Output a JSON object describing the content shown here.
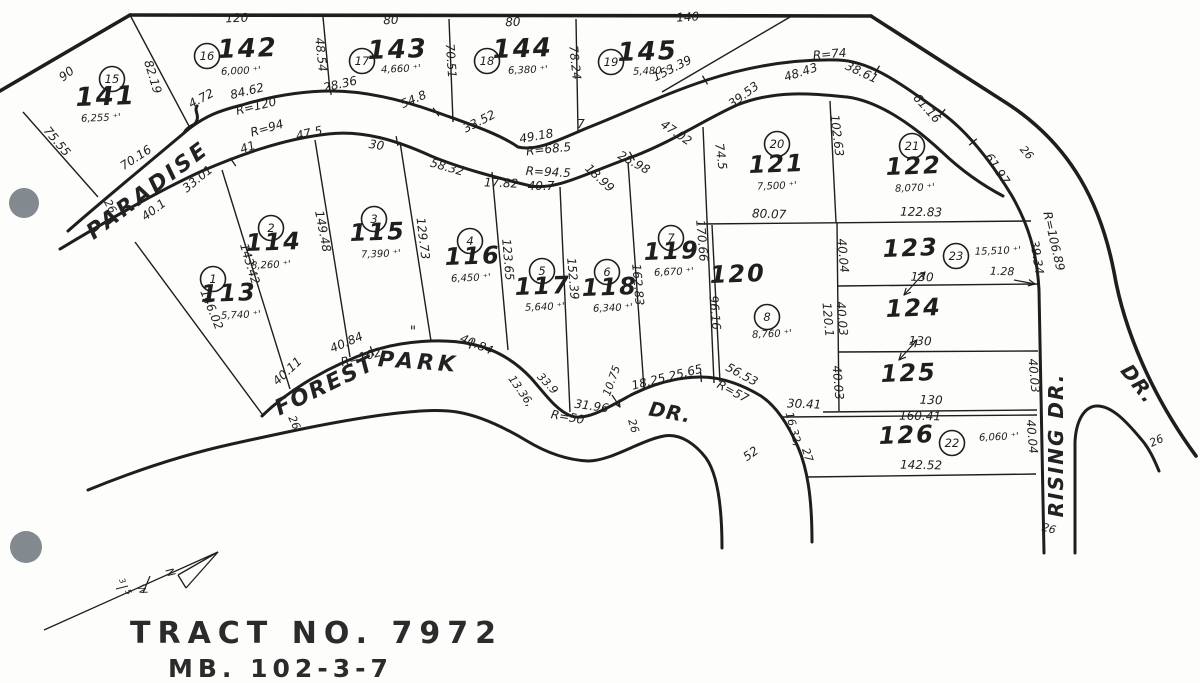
{
  "title": "TRACT  NO.  7972",
  "subtitle": "MB. 102-3-7",
  "area_suffix": " ⁺'",
  "scan": {
    "paper": "#fdfdfc",
    "ink": "#1e1e1e",
    "punch_color": "#828a90",
    "hole_punches": [
      [
        24,
        203,
        15
      ],
      [
        26,
        547,
        16
      ]
    ]
  },
  "streets": [
    {
      "name": "PARADISE",
      "x": 152,
      "y": 196,
      "r": -37,
      "s": 22,
      "ls": 3
    },
    {
      "name": "FOREST",
      "x": 328,
      "y": 392,
      "r": -26,
      "s": 22,
      "ls": 2
    },
    {
      "name": "PARK",
      "x": 418,
      "y": 369,
      "r": 4,
      "s": 22,
      "ls": 4
    },
    {
      "name": "DR.",
      "x": 669,
      "y": 419,
      "r": 10,
      "s": 20,
      "ls": 1
    },
    {
      "name": "RISING  DR.",
      "x": 1063,
      "y": 445,
      "r": -90,
      "s": 20,
      "ls": 2
    },
    {
      "name": "DR.",
      "x": 1133,
      "y": 388,
      "r": 52,
      "s": 20,
      "ls": 1
    }
  ],
  "lots": [
    {
      "number": "141",
      "badge": "15",
      "area": "6,255",
      "num": [
        106,
        105,
        26
      ],
      "badge_pos": [
        112,
        79
      ],
      "area_pos": [
        101,
        121
      ]
    },
    {
      "number": "142",
      "badge": "16",
      "area": "6,000",
      "num": [
        248,
        57,
        26
      ],
      "badge_pos": [
        207,
        56
      ],
      "area_pos": [
        241,
        74
      ]
    },
    {
      "number": "143",
      "badge": "17",
      "area": "4,660",
      "num": [
        398,
        58,
        26
      ],
      "badge_pos": [
        362,
        61
      ],
      "area_pos": [
        401,
        72
      ]
    },
    {
      "number": "144",
      "badge": "18",
      "area": "6,380",
      "num": [
        523,
        57,
        26
      ],
      "badge_pos": [
        487,
        61
      ],
      "area_pos": [
        528,
        73
      ]
    },
    {
      "number": "145",
      "badge": "19",
      "area": "5,480",
      "num": [
        648,
        60,
        26
      ],
      "badge_pos": [
        611,
        62
      ],
      "area_pos": [
        653,
        74
      ]
    },
    {
      "number": "113",
      "badge": "1",
      "area": "5,740",
      "num": [
        229,
        301,
        24
      ],
      "badge_pos": [
        213,
        279
      ],
      "area_pos": [
        241,
        318
      ]
    },
    {
      "number": "114",
      "badge": "2",
      "area": "8,260",
      "num": [
        274,
        250,
        24
      ],
      "badge_pos": [
        271,
        228
      ],
      "area_pos": [
        271,
        268
      ]
    },
    {
      "number": "115",
      "badge": "3",
      "area": "7,390",
      "num": [
        378,
        240,
        24
      ],
      "badge_pos": [
        374,
        219
      ],
      "area_pos": [
        381,
        257
      ]
    },
    {
      "number": "116",
      "badge": "4",
      "area": "6,450",
      "num": [
        473,
        264,
        24
      ],
      "badge_pos": [
        470,
        241
      ],
      "area_pos": [
        471,
        281
      ]
    },
    {
      "number": "117",
      "badge": "5",
      "area": "5,640",
      "num": [
        543,
        294,
        24
      ],
      "badge_pos": [
        542,
        271
      ],
      "area_pos": [
        545,
        310
      ]
    },
    {
      "number": "118",
      "badge": "6",
      "area": "6,340",
      "num": [
        610,
        295,
        24
      ],
      "badge_pos": [
        607,
        272
      ],
      "area_pos": [
        613,
        311
      ]
    },
    {
      "number": "119",
      "badge": "7",
      "area": "6,670",
      "num": [
        672,
        259,
        24
      ],
      "badge_pos": [
        671,
        238
      ],
      "area_pos": [
        674,
        275
      ]
    },
    {
      "number": "120",
      "badge": "8",
      "area": "8,760",
      "num": [
        738,
        282,
        24
      ],
      "badge_pos": [
        767,
        317
      ],
      "area_pos": [
        772,
        337
      ]
    },
    {
      "number": "121",
      "badge": "20",
      "area": "7,500",
      "num": [
        777,
        172,
        24
      ],
      "badge_pos": [
        777,
        144
      ],
      "area_pos": [
        777,
        189
      ]
    },
    {
      "number": "122",
      "badge": "21",
      "area": "8,070",
      "num": [
        914,
        174,
        24
      ],
      "badge_pos": [
        912,
        146
      ],
      "area_pos": [
        915,
        191
      ]
    },
    {
      "number": "123",
      "badge": "23",
      "area": "15,510",
      "num": [
        911,
        256,
        24
      ],
      "badge_pos": [
        956,
        256
      ],
      "area_pos": [
        998,
        254
      ]
    },
    {
      "number": "124",
      "num": [
        914,
        316,
        24
      ]
    },
    {
      "number": "125",
      "num": [
        909,
        381,
        24
      ]
    },
    {
      "number": "126",
      "badge": "22",
      "area": "6,060",
      "num": [
        907,
        443,
        24
      ],
      "badge_pos": [
        952,
        443
      ],
      "area_pos": [
        999,
        440
      ]
    }
  ],
  "dims": [
    {
      "t": "120",
      "x": 237,
      "y": 22,
      "r": -2
    },
    {
      "t": "80",
      "x": 391,
      "y": 24,
      "r": -2
    },
    {
      "t": "80",
      "x": 513,
      "y": 26,
      "r": -2
    },
    {
      "t": "140",
      "x": 688,
      "y": 21,
      "r": -3
    },
    {
      "t": "90",
      "x": 69,
      "y": 77,
      "r": -38
    },
    {
      "t": "82.19",
      "x": 149,
      "y": 78,
      "r": 73
    },
    {
      "t": "48.54",
      "x": 317,
      "y": 55,
      "r": 84
    },
    {
      "t": "70.51",
      "x": 447,
      "y": 61,
      "r": 86
    },
    {
      "t": "78.24",
      "x": 571,
      "y": 63,
      "r": 84
    },
    {
      "t": "153.39",
      "x": 674,
      "y": 72,
      "r": -27
    },
    {
      "t": "75.55",
      "x": 54,
      "y": 144,
      "r": 50
    },
    {
      "t": "70.16",
      "x": 138,
      "y": 161,
      "r": -33
    },
    {
      "t": "4.72",
      "x": 203,
      "y": 102,
      "r": -28
    },
    {
      "t": "84.62",
      "x": 248,
      "y": 95,
      "r": -14
    },
    {
      "t": "R=120",
      "x": 257,
      "y": 110,
      "r": -14
    },
    {
      "t": "28.36",
      "x": 341,
      "y": 88,
      "r": -13
    },
    {
      "t": "54.8",
      "x": 415,
      "y": 103,
      "r": -23
    },
    {
      "t": "33.52",
      "x": 481,
      "y": 125,
      "r": -27
    },
    {
      "t": "49.18",
      "x": 537,
      "y": 140,
      "r": -10
    },
    {
      "t": "R=68.5",
      "x": 549,
      "y": 153,
      "r": -6
    },
    {
      "t": "7",
      "x": 581,
      "y": 128,
      "r": 0
    },
    {
      "t": "39.53",
      "x": 746,
      "y": 98,
      "r": -37
    },
    {
      "t": "48.43",
      "x": 802,
      "y": 76,
      "r": -18
    },
    {
      "t": "R=74",
      "x": 830,
      "y": 58,
      "r": -5
    },
    {
      "t": "38.61",
      "x": 860,
      "y": 76,
      "r": 25
    },
    {
      "t": "61.16",
      "x": 924,
      "y": 111,
      "r": 48
    },
    {
      "t": "61.97",
      "x": 994,
      "y": 171,
      "r": 57
    },
    {
      "t": "26",
      "x": 1024,
      "y": 155,
      "r": 48,
      "s": 11
    },
    {
      "t": "39.34",
      "x": 1033,
      "y": 258,
      "r": 81
    },
    {
      "t": "R=106.89",
      "x": 1050,
      "y": 242,
      "r": 77
    },
    {
      "t": "R=94",
      "x": 268,
      "y": 132,
      "r": -16
    },
    {
      "t": "41",
      "x": 249,
      "y": 151,
      "r": -19
    },
    {
      "t": "47.5",
      "x": 310,
      "y": 137,
      "r": -13
    },
    {
      "t": "30",
      "x": 376,
      "y": 149,
      "r": 8
    },
    {
      "t": "58.32",
      "x": 446,
      "y": 171,
      "r": 16
    },
    {
      "t": "R=94.5",
      "x": 548,
      "y": 176,
      "r": 3
    },
    {
      "t": "17.82",
      "x": 501,
      "y": 187,
      "r": 2
    },
    {
      "t": "40.7",
      "x": 541,
      "y": 190,
      "r": 0
    },
    {
      "t": "18.99",
      "x": 597,
      "y": 181,
      "r": 43
    },
    {
      "t": "26.98",
      "x": 632,
      "y": 166,
      "r": 29
    },
    {
      "t": "47.02",
      "x": 674,
      "y": 136,
      "r": 34
    },
    {
      "t": "40.1",
      "x": 156,
      "y": 213,
      "r": -37
    },
    {
      "t": "33.01",
      "x": 200,
      "y": 182,
      "r": -39
    },
    {
      "t": "74.5",
      "x": 717,
      "y": 157,
      "r": 82
    },
    {
      "t": "102.63",
      "x": 833,
      "y": 136,
      "r": 83
    },
    {
      "t": "170.66",
      "x": 698,
      "y": 241,
      "r": 85
    },
    {
      "t": "96.16",
      "x": 711,
      "y": 313,
      "r": 85
    },
    {
      "t": "143.42",
      "x": 246,
      "y": 265,
      "r": 73
    },
    {
      "t": "146.02",
      "x": 208,
      "y": 311,
      "r": 68
    },
    {
      "t": "149.48",
      "x": 319,
      "y": 232,
      "r": 79
    },
    {
      "t": "129.73",
      "x": 419,
      "y": 239,
      "r": 83
    },
    {
      "t": "123.65",
      "x": 504,
      "y": 260,
      "r": 85
    },
    {
      "t": "152.39",
      "x": 569,
      "y": 279,
      "r": 85
    },
    {
      "t": "162.83",
      "x": 634,
      "y": 285,
      "r": 85
    },
    {
      "t": "80.07",
      "x": 769,
      "y": 218,
      "r": 2
    },
    {
      "t": "122.83",
      "x": 921,
      "y": 216,
      "r": 1
    },
    {
      "t": "40.04",
      "x": 839,
      "y": 256,
      "r": 85
    },
    {
      "t": "40.03",
      "x": 838,
      "y": 319,
      "r": 85
    },
    {
      "t": "120.1",
      "x": 824,
      "y": 320,
      "r": 85
    },
    {
      "t": "130",
      "x": 922,
      "y": 281,
      "r": 2
    },
    {
      "t": "1.28",
      "x": 1002,
      "y": 275,
      "r": 2,
      "s": 11
    },
    {
      "t": "130",
      "x": 920,
      "y": 345,
      "r": 2
    },
    {
      "t": "40.03",
      "x": 834,
      "y": 383,
      "r": 85
    },
    {
      "t": "40.03",
      "x": 1030,
      "y": 376,
      "r": 85
    },
    {
      "t": "130",
      "x": 931,
      "y": 404,
      "r": 2
    },
    {
      "t": "160.41",
      "x": 920,
      "y": 420,
      "r": 1
    },
    {
      "t": "30.41",
      "x": 804,
      "y": 408,
      "r": 2
    },
    {
      "t": "16.32,",
      "x": 790,
      "y": 430,
      "r": 75,
      "s": 11
    },
    {
      "t": "27",
      "x": 804,
      "y": 456,
      "r": 72,
      "s": 11
    },
    {
      "t": "40.04",
      "x": 1028,
      "y": 437,
      "r": 85
    },
    {
      "t": "142.52",
      "x": 921,
      "y": 469,
      "r": 1
    },
    {
      "t": "26",
      "x": 1048,
      "y": 532,
      "r": 15,
      "s": 11
    },
    {
      "t": "26",
      "x": 1158,
      "y": 444,
      "r": -25,
      "s": 11
    },
    {
      "t": "40.11",
      "x": 290,
      "y": 374,
      "r": -43
    },
    {
      "t": "40.84",
      "x": 348,
      "y": 346,
      "r": -23
    },
    {
      "t": "R=102",
      "x": 362,
      "y": 361,
      "r": -15
    },
    {
      "t": "\"",
      "x": 413,
      "y": 336,
      "r": 0,
      "s": 14
    },
    {
      "t": "40.84",
      "x": 475,
      "y": 348,
      "r": 23
    },
    {
      "t": "13.36,",
      "x": 518,
      "y": 393,
      "r": 55,
      "s": 11
    },
    {
      "t": "33.9",
      "x": 545,
      "y": 386,
      "r": 46,
      "s": 11
    },
    {
      "t": "31.96",
      "x": 591,
      "y": 410,
      "r": 8
    },
    {
      "t": "R=50",
      "x": 567,
      "y": 421,
      "r": 10
    },
    {
      "t": "10.75",
      "x": 615,
      "y": 382,
      "r": -70,
      "s": 11
    },
    {
      "t": "18.25,25.65",
      "x": 668,
      "y": 381,
      "r": -14
    },
    {
      "t": "56.53",
      "x": 740,
      "y": 378,
      "r": 28
    },
    {
      "t": "R=57",
      "x": 731,
      "y": 395,
      "r": 28
    },
    {
      "t": "26",
      "x": 630,
      "y": 427,
      "r": 73,
      "s": 11
    },
    {
      "t": "52",
      "x": 753,
      "y": 457,
      "r": -35
    },
    {
      "t": "26",
      "x": 107,
      "y": 208,
      "r": 62,
      "s": 11
    },
    {
      "t": "26",
      "x": 291,
      "y": 424,
      "r": 66,
      "s": 11
    }
  ],
  "paths": {
    "boundary": [
      "M0,91 L130,15",
      "M130,15 L871,16",
      "M871,16 L1008,104 C1072,146 1101,205 1114,272 C1124,330 1152,396 1196,456"
    ],
    "roads": [
      "M68,231 C95,207 140,170 190,128 C206,116 218,111 242,105 C272,96 302,91 332,91 C366,91 402,100 436,112 C466,123 498,133 518,147 C538,152 562,138 592,126 C632,110 667,93 707,80 C747,67 792,59 838,60 C872,61 902,85 942,113 C968,132 992,163 1012,196 C1028,224 1037,252 1039,290 L1044,553",
      "M60,249 C102,224 152,194 202,171 C237,156 282,139 328,134 C362,130 396,140 431,156 C462,169 502,179 531,186 C557,190 582,175 632,157 C672,142 702,121 737,105 C777,89 817,94 847,97 C878,101 912,124 942,152 C962,171 984,186 1003,196",
      "M262,416 C292,387 332,365 372,351 C402,341 442,338 471,344 C496,349 516,362 531,378 C546,395 556,410 571,416 C586,421 606,409 631,395 C651,385 676,377 701,377 C721,377 741,384 761,396 C776,406 788,424 798,447 C807,468 812,496 812,542",
      "M88,490 C132,472 182,455 232,444 C282,433 332,422 382,415 C412,411 437,409 457,412 C482,416 507,429 527,441 C547,453 567,460 588,461 C611,461 641,440 664,436 C681,433 696,445 706,458 C716,472 722,500 722,548",
      "M1075,553 L1075,442 C1076,421 1084,407 1096,406 C1111,405 1126,421 1141,439 C1149,448 1154,459 1159,471",
      "M184,133 C189,124 195,127 197,120 C199,114 194,111 197,106"
    ],
    "lot_lines": [
      [
        130,
        15,
        190,
        128
      ],
      [
        23,
        112,
        98,
        197
      ],
      [
        323,
        17,
        330,
        91
      ],
      [
        449,
        19,
        453,
        122
      ],
      [
        576,
        19,
        578,
        131
      ],
      [
        790,
        17,
        662,
        92
      ],
      [
        135,
        242,
        262,
        414
      ],
      [
        222,
        170,
        290,
        389
      ],
      [
        315,
        140,
        350,
        357
      ],
      [
        400,
        142,
        431,
        341
      ],
      [
        492,
        172,
        508,
        350
      ],
      [
        560,
        187,
        570,
        412
      ],
      [
        628,
        162,
        644,
        389
      ],
      [
        703,
        127,
        714,
        383
      ],
      [
        712,
        225,
        720,
        382
      ],
      [
        830,
        101,
        836,
        222
      ],
      [
        698,
        224,
        1031,
        221
      ],
      [
        837,
        222,
        839,
        411
      ],
      [
        838,
        286,
        1039,
        284
      ],
      [
        838,
        352,
        1038,
        351
      ],
      [
        823,
        412,
        1037,
        410
      ],
      [
        783,
        417,
        1037,
        415
      ],
      [
        808,
        477,
        1036,
        474
      ]
    ],
    "ticks": [
      [
        330,
        90,
        75
      ],
      [
        436,
        112,
        55
      ],
      [
        705,
        80,
        60
      ],
      [
        877,
        70,
        -60
      ],
      [
        973,
        142,
        -40
      ],
      [
        233,
        162,
        55
      ],
      [
        397,
        141,
        80
      ],
      [
        632,
        156,
        60
      ],
      [
        372,
        351,
        70
      ],
      [
        471,
        344,
        110
      ],
      [
        701,
        377,
        85
      ],
      [
        942,
        113,
        -50
      ]
    ],
    "arrows": [
      {
        "l": [
          904,
          295,
          925,
          272
        ],
        "heads": "both"
      },
      {
        "l": [
          899,
          360,
          917,
          340
        ],
        "heads": "both"
      },
      {
        "l": [
          1014,
          280,
          1035,
          284
        ],
        "heads": "end"
      },
      {
        "l": [
          612,
          395,
          620,
          407
        ],
        "heads": "end"
      }
    ]
  },
  "north_arrow": {
    "line": [
      44,
      630,
      218,
      552
    ],
    "head": [
      [
        218,
        552,
        178,
        575
      ],
      [
        218,
        552,
        186,
        588
      ],
      [
        186,
        588,
        178,
        575
      ]
    ],
    "cross_tick": [
      150,
      576,
      143,
      593
    ],
    "frac_bar": [
      116,
      589,
      128,
      586
    ],
    "marks": [
      {
        "t": "N",
        "x": 167,
        "y": 574,
        "r": 65,
        "s": 11
      },
      {
        "t": "W",
        "x": 139,
        "y": 591,
        "r": 65,
        "s": 10
      },
      {
        "t": "3",
        "x": 120,
        "y": 582,
        "r": 65,
        "s": 8
      },
      {
        "t": "5",
        "x": 126,
        "y": 593,
        "r": 65,
        "s": 8
      }
    ]
  }
}
